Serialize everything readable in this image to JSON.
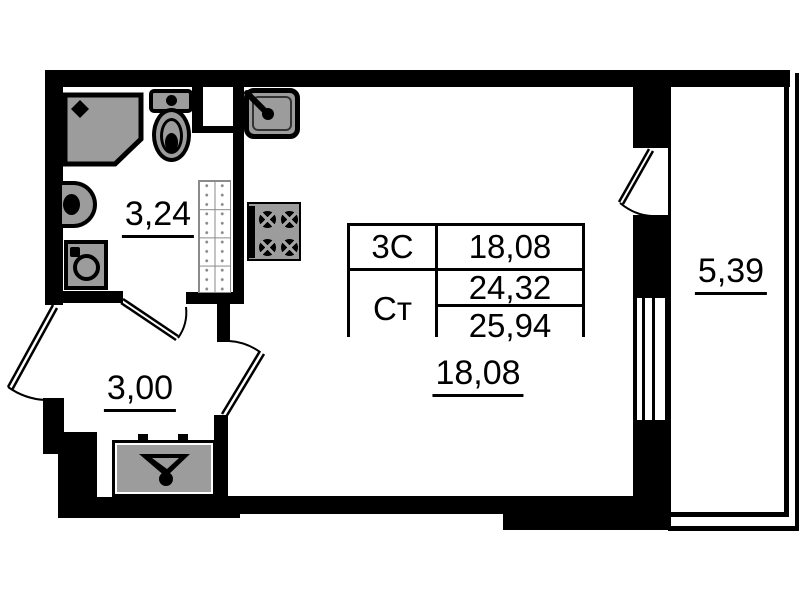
{
  "colors": {
    "wall": "#000000",
    "fixture_fill": "#9c9c9c",
    "background": "#ffffff"
  },
  "areas": {
    "bathroom": "3,24",
    "hallway": "3,00",
    "living_room": "18,08",
    "balcony": "5,39"
  },
  "info_table": {
    "plan_code": "3С",
    "unit_type": "Ст",
    "living_area": "18,08",
    "area_without_balcony": "24,32",
    "total_area": "25,94"
  },
  "fixtures": {
    "bathroom": [
      "shower",
      "toilet",
      "washbasin",
      "washing-machine",
      "shelf-unit"
    ],
    "kitchen_zone": [
      "kitchen-sink",
      "stove"
    ],
    "hallway": [
      "wardrobe"
    ],
    "openings": [
      "entrance-door",
      "bathroom-door",
      "living-room-door",
      "balcony-door",
      "balcony-window"
    ]
  }
}
